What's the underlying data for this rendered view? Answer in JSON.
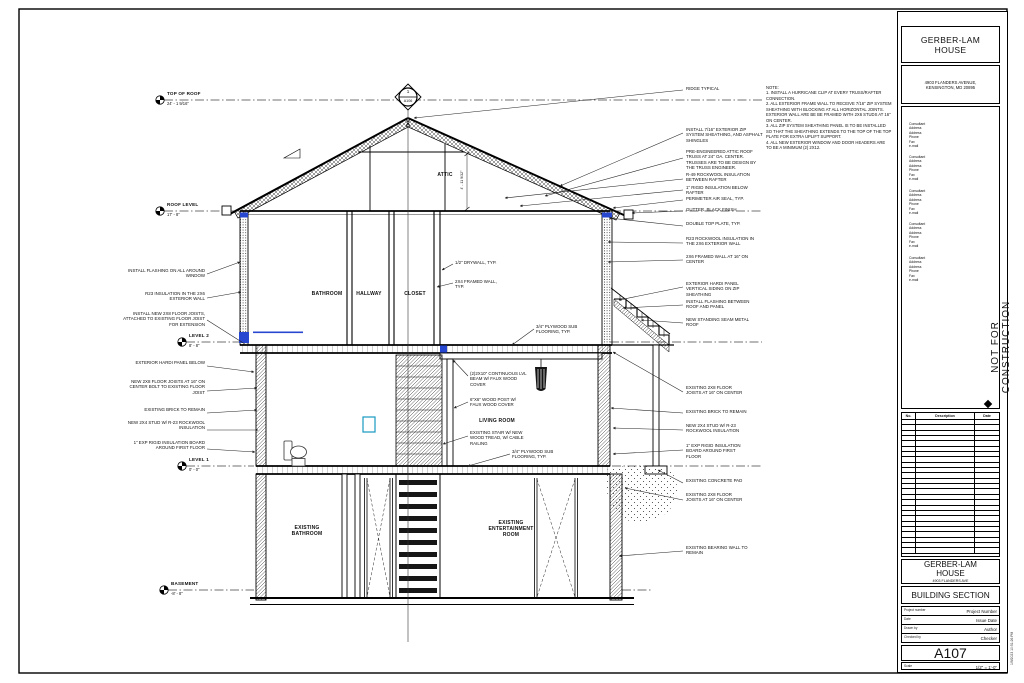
{
  "titleblock": {
    "firm_name": "GERBER-LAM\nHOUSE",
    "firm_address": "4903 FLANDERS AVENUE,\nKENSINGTON, MD 20895",
    "consultant_block": "Consultant\nAddress\nAddress\nPhone\nFax\ne-mail",
    "stamp": "NOT FOR CONSTRUCTION",
    "revision_headers": {
      "no": "No.",
      "description": "Description",
      "date": "Date"
    },
    "revision_row_count": 25,
    "project_name": "GERBER-LAM\nHOUSE",
    "project_address": "4903 FLANDERS AVE",
    "sheet_title": "BUILDING SECTION",
    "fields": [
      {
        "label": "Project number",
        "value": "Project Number"
      },
      {
        "label": "Date",
        "value": "Issue Date"
      },
      {
        "label": "Drawn by",
        "value": "Author"
      },
      {
        "label": "Checked by",
        "value": "Checker"
      }
    ],
    "sheet_number": "A107",
    "scale_label": "Scale",
    "scale_value": "1/2\" = 1'-0\"",
    "plot_stamp": "1/9/2023 10:51:26 PM"
  },
  "notes": "NOTE:\n1. INSTALL A HURRICANE CLIP AT EVERY TRUSS/RAFTER CONNECTION.\n2. ALL EXTERIOR FRAME WALL TO RECEIVE 7/16\" ZIP SYSTEM SHEATHING WITH BLOCKING AT ALL HORIZONTAL JOINTS. EXTERIOR WALL ARE BE BE FRAMED WITH 2X6 STUDS AT 16\" ON CENTER.\n3. ALL ZIP SYSTEM SHEATHING PANEL IS TO BE INSTALLED SO THAT THE SHEATHING EXTENDS TO THE TOP OF THE TOP PLATE FOR EXTRA UPLIFT SUPPORT.\n4. ALL NEW EXTERIOR WINDOW AND DOOR HEADERS ARE TO BE A MINIMUM (2) 2X12.",
  "levels": [
    {
      "name": "TOP OF ROOF",
      "elevation": "24' - 1 9/16\""
    },
    {
      "name": "ROOF LEVEL",
      "elevation": "17' - 8\""
    },
    {
      "name": "LEVEL 2",
      "elevation": "8' - 8\""
    },
    {
      "name": "LEVEL 1",
      "elevation": "0' - 0\""
    },
    {
      "name": "BASEMENT",
      "elevation": "-8' - 8\""
    }
  ],
  "rooms": {
    "attic": "ATTIC",
    "bathroom": "BATHROOM",
    "hallway": "HALLWAY",
    "closet": "CLOSET",
    "living_room": "LIVING ROOM",
    "existing_bathroom": "EXISTING\nBATHROOM",
    "existing_entertainment_room": "EXISTING\nENTERTAINMENT\nROOM"
  },
  "section_marker": {
    "detail_number": "1",
    "sheet_ref": "A106"
  },
  "dimensions": {
    "attic_height": "4' - 11 9/32\""
  },
  "annotations": {
    "right": [
      "RIDGE TYPICAL",
      "INSTALL 7/16\" EXTERIOR ZIP SYSTEM SHEATHING, AND ASPHALT SHINGLES",
      "PRE-ENGINEERED ATTIC ROOF TRUSS AT 24\" OA. CENTER. TRUSSES ARE TO BE DESIGN BY THE TRUSS ENGINEER.",
      "R-49 ROCKWOOL INSULATION BETWEEN RAFTER",
      "1\" RIGID INSULATION BELOW RAFTER",
      "PERIMETER AIR SEAL, TYP.",
      "GUTTER, BLACK FINISH",
      "DOUBLE TOP PLATE, TYP.",
      "R23 ROCKWOOL INSULATION IN THE 2X6 EXTERIOR WALL",
      "2X6 FRAMED WALL AT 16\" ON CENTER",
      "EXTERIOR HARDI PANEL VERTICAL SIDING ON ZIP SHEATHING",
      "INSTALL FLASHING BETWEEN ROOF AND PANEL",
      "NEW STANDING SEAM METAL ROOF",
      "EXISTING 2X8 FLOOR JOISTS AT 16\" ON CENTER",
      "EXISTING BRICK TO REMAIN",
      "NEW 2X4 STUD W/ R-23 ROCKWOOL INSULATION",
      "1\" EXP RIGID INSULATION BOARD AROUND FIRST FLOOR",
      "EXISTING CONCRETE PAD",
      "EXISTING 2X8 FLOOR JOISTS AT 16\" ON CENTER",
      "EXISTING BEARING WALL TO REMAIN"
    ],
    "left": [
      "INSTALL FLASHING ON ALL AROUND WINDOW",
      "R23 INSULATION IN THE 2X6 EXTERIOR WALL",
      "INSTALL NEW 2X8 FLOOR JOISTS, ATTACHED TO EXISTING FLOOR JOIST FOR EXTENSION",
      "EXTERIOR HARDI PANEL BELOW",
      "NEW 2X8 FLOOR JOISTS AT 16\" ON CENTER BOLT TO EXISTING FLOOR JOIST",
      "EXISTING BRICK TO REMAIN",
      "NEW 2X4 STUD W/ R-23 ROCKWOOL INSULATION",
      "1\" EXP RIGID INSULATION BOARD AROUND FIRST FLOOR"
    ],
    "interior": [
      "1/2\" DRYWALL, TYP.",
      "2X4 FRAMED WALL, TYP.",
      "3/4\" PLYWOOD SUB FLOORING, TYP.",
      "(2)2X10\" CONTINUOUS LVL BEAM W/ FAUX WOOD COVER",
      "6\"X6\" WOOD POST W/ FAUX WOOD COVER",
      "EXISTING STAIR W/ NEW WOOD TREAD, W/ CABLE RAILING",
      "3/4\" PLYWOOD SUB FLOORING, TYP."
    ]
  },
  "colors": {
    "accent_blue": "#2847d0",
    "accent_cyan": "#1899c2",
    "line": "#111111"
  }
}
